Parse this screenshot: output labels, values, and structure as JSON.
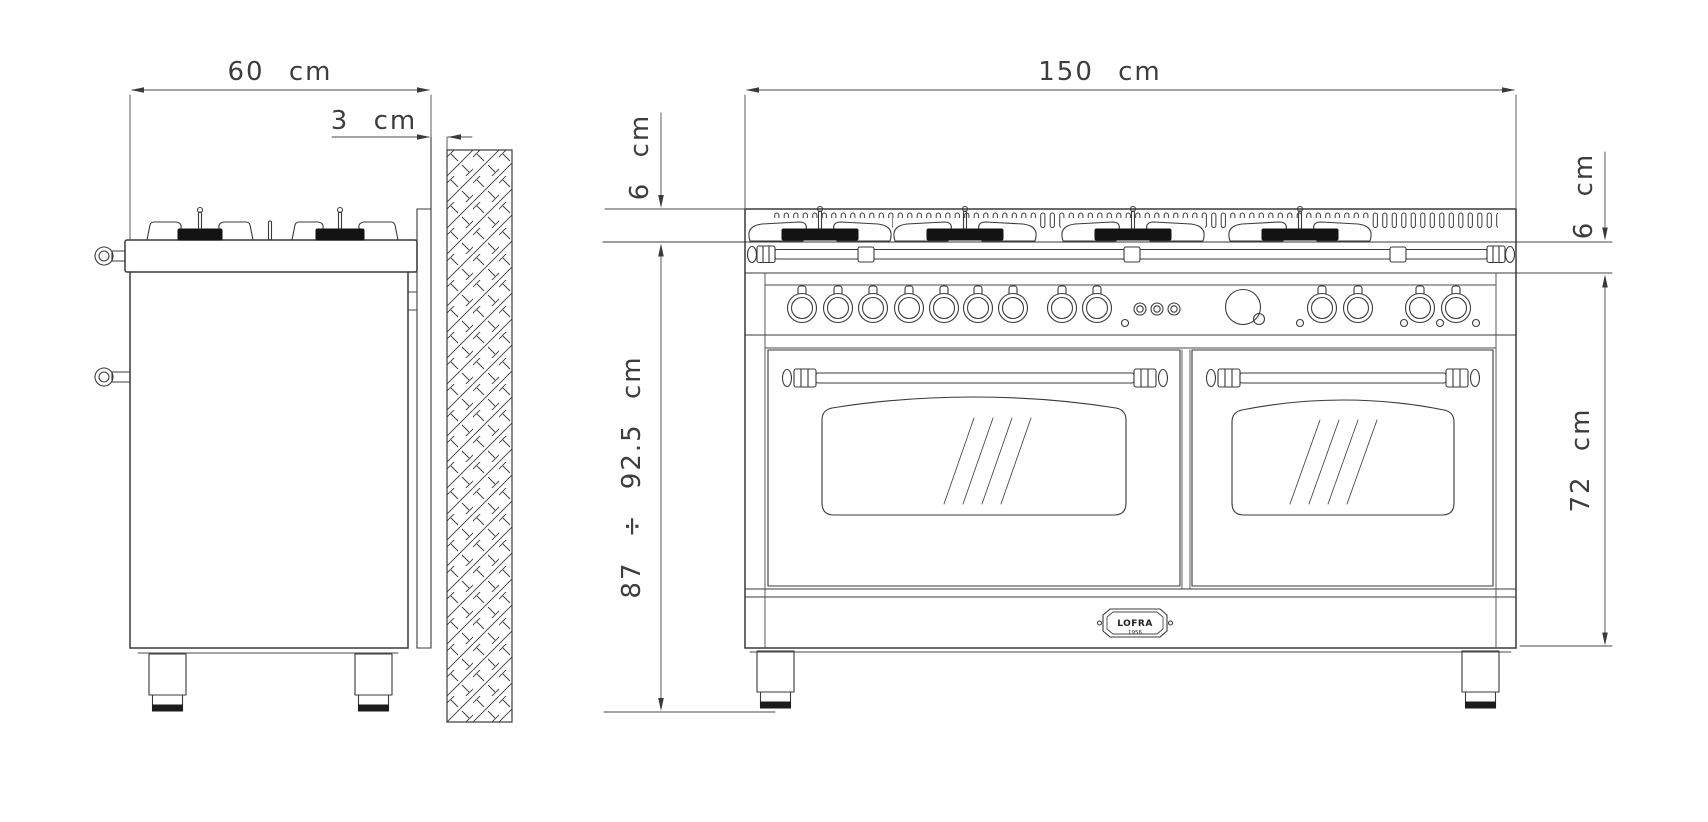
{
  "drawing": {
    "side_view": {
      "width_label": "60 cm",
      "gap_label": "3 cm"
    },
    "front_view": {
      "width_label": "150 cm",
      "left_backguard_label": "6 cm",
      "right_backguard_label": "6 cm",
      "overall_height_label": "87 ÷ 92.5 cm",
      "oven_height_label": "72 cm",
      "badge": {
        "brand": "LOFRA",
        "year": "1956"
      },
      "controls": {
        "knob_count": 13,
        "button_count": 3,
        "indicator_light_count": 5,
        "has_clock": true
      },
      "burner_count": 4,
      "oven_door_count": 2
    },
    "colors": {
      "line": "#3a3a3a",
      "background": "#ffffff",
      "burner_cap": "#131313",
      "foot": "#1c1c1c"
    }
  }
}
